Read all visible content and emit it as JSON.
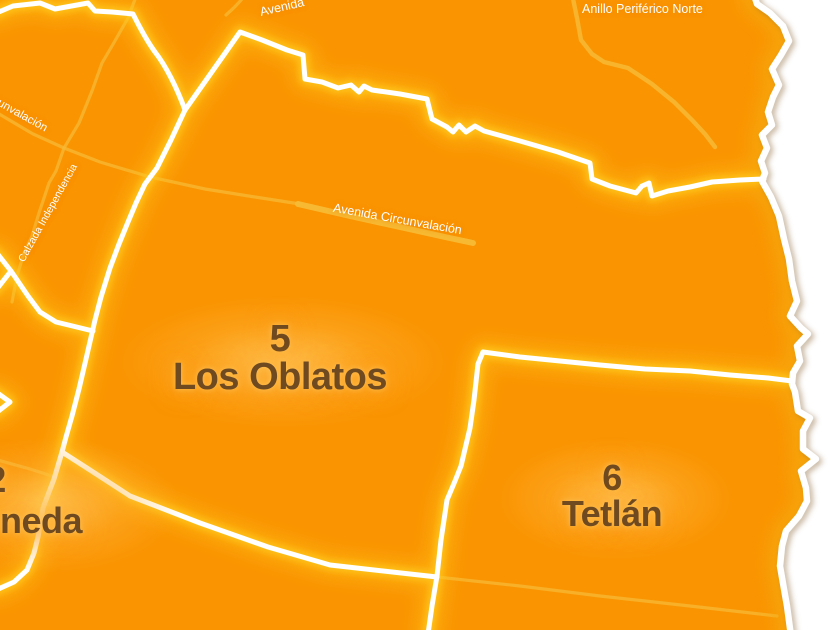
{
  "map": {
    "colors": {
      "bg_orange": "#FA9401",
      "glow_yellow": "#FFC91F",
      "road_yellow": "#F7BA35",
      "line_white": "#FFFFFF",
      "outside_white": "#FFFFFF",
      "inner_shadow": "#E88400",
      "label_brown": "#6F4A21",
      "road_label_white": "#FFFFFF"
    },
    "districts": [
      {
        "number": "5",
        "name": "Los Oblatos"
      },
      {
        "number": "6",
        "name": "Tetlán"
      },
      {
        "number": "2",
        "name_visible": "neda"
      }
    ],
    "road_labels": [
      {
        "id": "circunvalacion-west",
        "text": "Avenida Circunvalación"
      },
      {
        "id": "circunvalacion-mid",
        "text": "Avenida Circunvalación"
      },
      {
        "id": "calzada",
        "text": "Calzada Independencia"
      },
      {
        "id": "periferico",
        "text": "Anillo Periférico Norte"
      },
      {
        "id": "avenida-top",
        "text": "Avenida"
      }
    ]
  }
}
